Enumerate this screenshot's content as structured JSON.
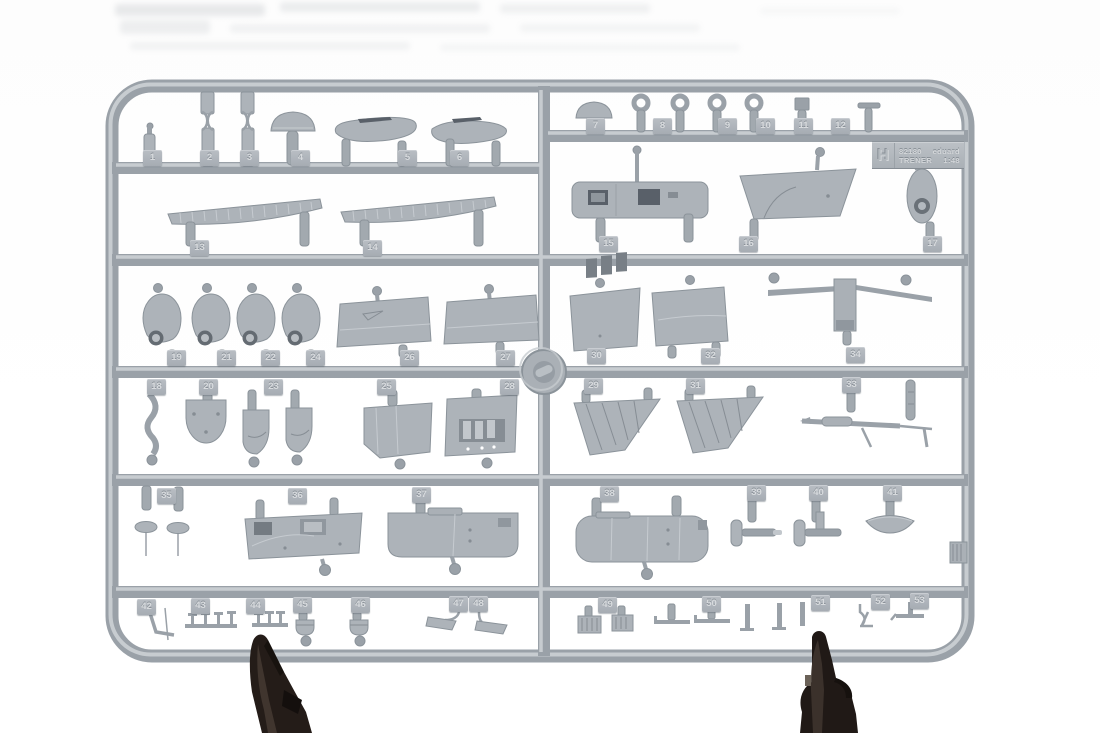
{
  "scene": {
    "background": "#ffffff",
    "sprue_base_color": "#a8aeb4",
    "sprue_shadow_color": "#868e95",
    "sprue_highlight_color": "#c9ced2",
    "clip_color": "#241c18"
  },
  "label_plate": {
    "letter": "H",
    "code": "82180",
    "brand": "eduard",
    "name": "TRENER",
    "scale": "1:48"
  },
  "part_tags": [
    {
      "n": "1",
      "x": 152,
      "y": 150
    },
    {
      "n": "2",
      "x": 209,
      "y": 150
    },
    {
      "n": "3",
      "x": 249,
      "y": 150
    },
    {
      "n": "4",
      "x": 300,
      "y": 150
    },
    {
      "n": "5",
      "x": 407,
      "y": 150
    },
    {
      "n": "6",
      "x": 459,
      "y": 150
    },
    {
      "n": "7",
      "x": 595,
      "y": 118
    },
    {
      "n": "8",
      "x": 662,
      "y": 118
    },
    {
      "n": "9",
      "x": 727,
      "y": 118
    },
    {
      "n": "10",
      "x": 765,
      "y": 118
    },
    {
      "n": "11",
      "x": 803,
      "y": 118
    },
    {
      "n": "12",
      "x": 840,
      "y": 118
    },
    {
      "n": "13",
      "x": 199,
      "y": 240
    },
    {
      "n": "14",
      "x": 372,
      "y": 240
    },
    {
      "n": "15",
      "x": 608,
      "y": 236
    },
    {
      "n": "16",
      "x": 748,
      "y": 236
    },
    {
      "n": "17",
      "x": 932,
      "y": 236
    },
    {
      "n": "19",
      "x": 176,
      "y": 350
    },
    {
      "n": "21",
      "x": 226,
      "y": 350
    },
    {
      "n": "22",
      "x": 270,
      "y": 350
    },
    {
      "n": "24",
      "x": 315,
      "y": 350
    },
    {
      "n": "26",
      "x": 409,
      "y": 350
    },
    {
      "n": "27",
      "x": 505,
      "y": 350
    },
    {
      "n": "30",
      "x": 596,
      "y": 348
    },
    {
      "n": "32",
      "x": 710,
      "y": 348
    },
    {
      "n": "34",
      "x": 855,
      "y": 347
    },
    {
      "n": "18",
      "x": 156,
      "y": 379
    },
    {
      "n": "20",
      "x": 208,
      "y": 379
    },
    {
      "n": "23",
      "x": 273,
      "y": 379
    },
    {
      "n": "25",
      "x": 386,
      "y": 379
    },
    {
      "n": "28",
      "x": 509,
      "y": 379
    },
    {
      "n": "29",
      "x": 593,
      "y": 378
    },
    {
      "n": "31",
      "x": 695,
      "y": 378
    },
    {
      "n": "33",
      "x": 851,
      "y": 377
    },
    {
      "n": "35",
      "x": 166,
      "y": 488
    },
    {
      "n": "36",
      "x": 297,
      "y": 488
    },
    {
      "n": "37",
      "x": 421,
      "y": 487
    },
    {
      "n": "38",
      "x": 609,
      "y": 486
    },
    {
      "n": "39",
      "x": 756,
      "y": 485
    },
    {
      "n": "40",
      "x": 818,
      "y": 485
    },
    {
      "n": "41",
      "x": 892,
      "y": 485
    },
    {
      "n": "42",
      "x": 146,
      "y": 599
    },
    {
      "n": "43",
      "x": 200,
      "y": 598
    },
    {
      "n": "44",
      "x": 255,
      "y": 598
    },
    {
      "n": "45",
      "x": 302,
      "y": 597
    },
    {
      "n": "46",
      "x": 360,
      "y": 597
    },
    {
      "n": "47",
      "x": 458,
      "y": 596
    },
    {
      "n": "48",
      "x": 478,
      "y": 596
    },
    {
      "n": "49",
      "x": 607,
      "y": 597
    },
    {
      "n": "50",
      "x": 711,
      "y": 596
    },
    {
      "n": "51",
      "x": 820,
      "y": 595
    },
    {
      "n": "52",
      "x": 880,
      "y": 594
    },
    {
      "n": "53",
      "x": 919,
      "y": 593
    }
  ]
}
